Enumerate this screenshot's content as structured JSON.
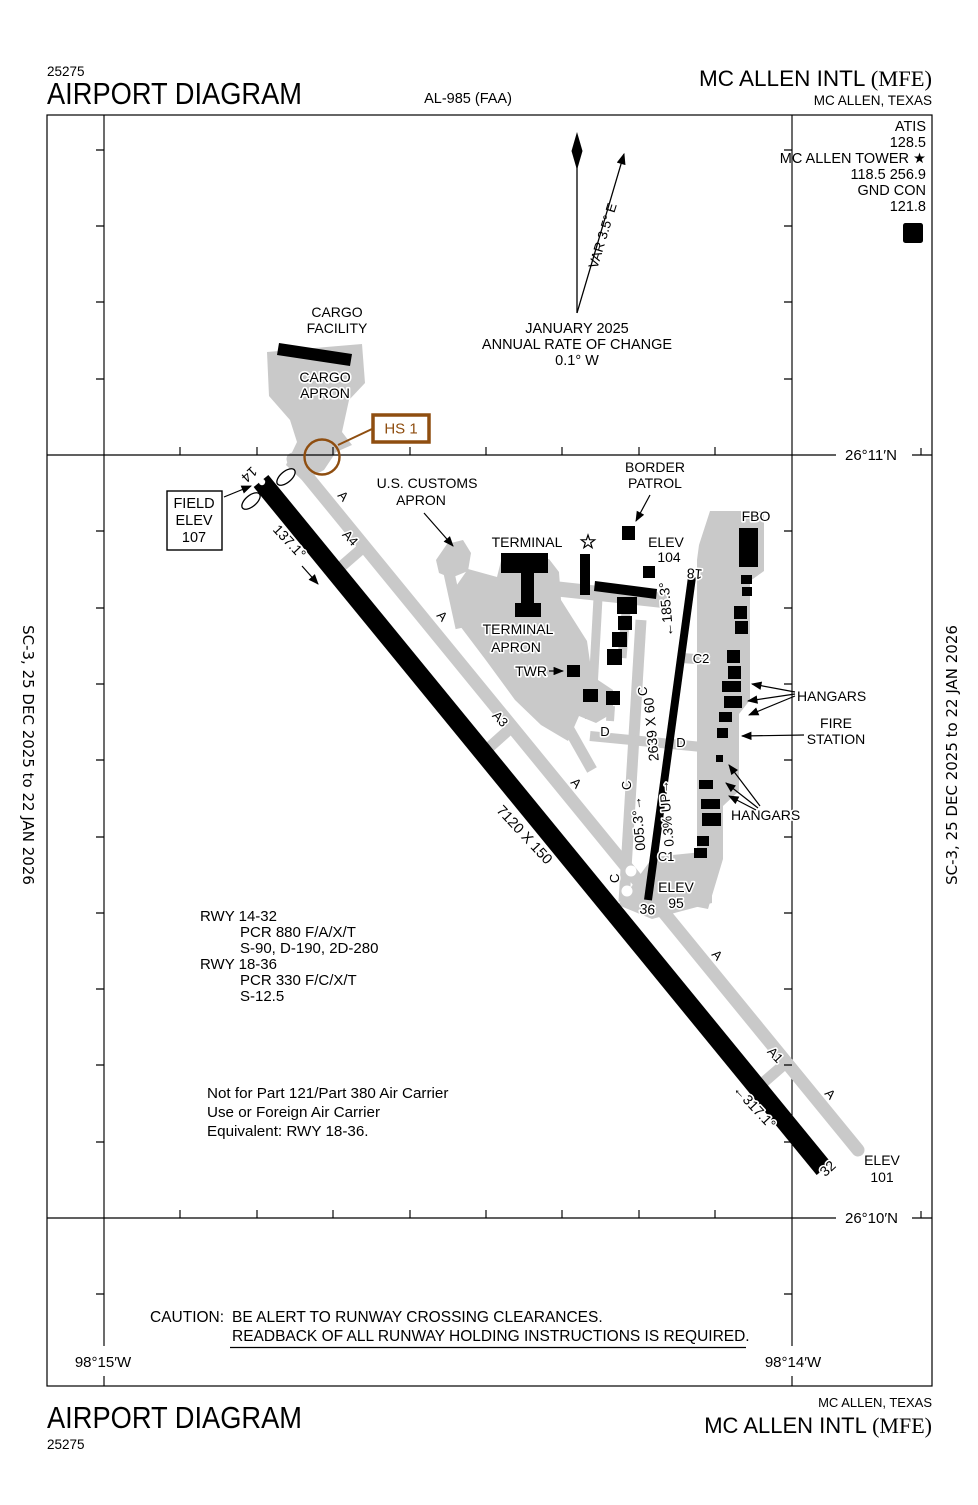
{
  "colors": {
    "hotspot": "#8f4e10",
    "apron": "#c9c9c9"
  },
  "header": {
    "chart_number": "25275",
    "title": "AIRPORT DIAGRAM",
    "procedure_code": "AL-985 (FAA)",
    "airport_name": "MC ALLEN INTL ",
    "airport_code": "(MFE)",
    "city": "MC ALLEN, TEXAS"
  },
  "comm": {
    "atis_label": "ATIS",
    "atis_freq": "128.5",
    "tower_label": "MC ALLEN TOWER ★",
    "tower_freq": "118.5 256.9",
    "gnd_label": "GND CON",
    "gnd_freq": "121.8",
    "hold_sign": "D"
  },
  "margin_note": "SC-3,  25 DEC 2025  to  22 JAN 2026",
  "compass": {
    "var_label": "VAR 3.5° E",
    "date_line": "JANUARY 2025",
    "rate_line1": "ANNUAL RATE OF CHANGE",
    "rate_line2": "0.1° W"
  },
  "grid": {
    "lat_top": "26°11′N",
    "lat_bottom": "26°10′N",
    "lon_left": "98°15′W",
    "lon_right": "98°14′W"
  },
  "field_elev": {
    "l1": "FIELD",
    "l2": "ELEV",
    "l3": "107"
  },
  "hotspot": {
    "label": "HS 1"
  },
  "areas": {
    "cargo_facility_l1": "CARGO",
    "cargo_facility_l2": "FACILITY",
    "cargo_apron_l1": "CARGO",
    "cargo_apron_l2": "APRON",
    "customs_l1": "U.S. CUSTOMS",
    "customs_l2": "APRON",
    "terminal": "TERMINAL",
    "terminal_apron_l1": "TERMINAL",
    "terminal_apron_l2": "APRON",
    "twr": "TWR",
    "border_l1": "BORDER",
    "border_l2": "PATROL",
    "fbo": "FBO",
    "hangars": "HANGARS",
    "fire_l1": "FIRE",
    "fire_l2": "STATION"
  },
  "elevations": {
    "elev": "ELEV",
    "e104": "104",
    "e95": "95",
    "e101": "101"
  },
  "runways": {
    "id14": "14",
    "id32": "32",
    "id18": "18",
    "id36": "36",
    "hdg14": "137.1°",
    "hdg32": "←317.1°",
    "dim1432": "7120 X 150",
    "hdg18": "←185.3°",
    "hdg36": "005.3°→",
    "slope": "0.3% UP→",
    "dim1836": "2639 X 60"
  },
  "taxiways": {
    "a": "A",
    "a1": "A1",
    "a3": "A3",
    "a4": "A4",
    "c": "C",
    "c1": "C1",
    "c2": "C2",
    "d": "D"
  },
  "runway_info": {
    "r1_id": "RWY 14-32",
    "r1_pcr": "PCR 880 F/A/X/T",
    "r1_strength": "S-90, D-190, 2D-280",
    "r2_id": "RWY 18-36",
    "r2_pcr": "PCR 330 F/C/X/T",
    "r2_strength": "S-12.5"
  },
  "notes": {
    "l1": "Not for Part 121/Part 380 Air Carrier",
    "l2": "Use or Foreign Air Carrier",
    "l3": "Equivalent: RWY 18-36."
  },
  "caution": {
    "prefix": "CAUTION:",
    "l1": "BE ALERT TO RUNWAY CROSSING CLEARANCES.",
    "l2": "READBACK OF ALL RUNWAY HOLDING INSTRUCTIONS IS REQUIRED."
  },
  "footer": {
    "title": "AIRPORT DIAGRAM",
    "chart_number": "25275",
    "city": "MC ALLEN, TEXAS",
    "airport_name": "MC ALLEN INTL ",
    "airport_code": "(MFE)"
  }
}
